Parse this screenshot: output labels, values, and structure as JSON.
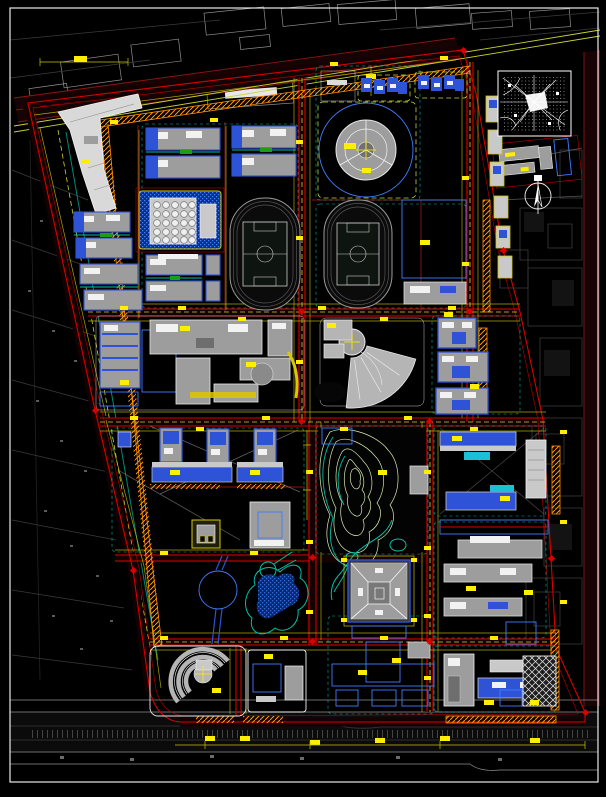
{
  "document": {
    "type": "cad-site-plan",
    "subject": "campus-master-plan"
  },
  "palette": {
    "bg": "#000000",
    "frame_white": "#e9e9e9",
    "road_red": "#d80000",
    "road_dark_red": "#8a1616",
    "road_fill": "#170303",
    "hatch_orange": "#ff9000",
    "annotation_yellow": "#ffee00",
    "dim_yellow": "#c8c400",
    "dash_green": "#c9d32f",
    "hatch_blue": "#3f7dff",
    "hatch_blue_dark": "#0d2f7e",
    "accent_blue": "#2e53d6",
    "building_gray": "#9d9d9d",
    "building_light": "#c9c9c9",
    "outline_white": "#f2f2f2",
    "context_gray": "#3a3a3a",
    "context_light": "#8f8f8f",
    "contour_green": "#d6ecae",
    "cyan": "#00e0d0",
    "teal": "#00c0a8"
  },
  "features": [
    {
      "name": "sheet-frame",
      "kind": "frame",
      "color_key": "frame_white"
    },
    {
      "name": "site-boundary",
      "kind": "boundary",
      "color_key": "road_red"
    },
    {
      "name": "road-network",
      "kind": "road",
      "color_key": "road_red"
    },
    {
      "name": "hatched-road-verges",
      "kind": "road-detail",
      "color_key": "hatch_orange"
    },
    {
      "name": "dormitory-rows",
      "kind": "building-group",
      "color_key": "building_gray"
    },
    {
      "name": "lattice-roof-building",
      "kind": "building",
      "color_key": "building_light"
    },
    {
      "name": "circular-plaza-building",
      "kind": "building",
      "color_key": "hatch_blue"
    },
    {
      "name": "north-dorm-clusters",
      "kind": "building-group",
      "color_key": "accent_blue"
    },
    {
      "name": "northeast-annex-parcel",
      "kind": "building-group",
      "color_key": "building_gray"
    },
    {
      "name": "running-track-west",
      "kind": "sports-field",
      "color_key": "building_light"
    },
    {
      "name": "running-track-east",
      "kind": "sports-field",
      "color_key": "building_light"
    },
    {
      "name": "basketball-court-grid",
      "kind": "sports-field",
      "color_key": "context_light"
    },
    {
      "name": "academic-courtyard-complex",
      "kind": "building-group",
      "color_key": "building_gray"
    },
    {
      "name": "fan-shaped-building",
      "kind": "building",
      "color_key": "building_gray"
    },
    {
      "name": "mid-east-buildings",
      "kind": "building-group",
      "color_key": "accent_blue"
    },
    {
      "name": "southwest-tower-group",
      "kind": "building-group",
      "color_key": "accent_blue"
    },
    {
      "name": "gatehouse",
      "kind": "building",
      "color_key": "dim_yellow"
    },
    {
      "name": "hill-contours",
      "kind": "landscape",
      "color_key": "contour_green"
    },
    {
      "name": "stream",
      "kind": "landscape",
      "color_key": "teal"
    },
    {
      "name": "circular-pond",
      "kind": "landscape",
      "color_key": "hatch_blue"
    },
    {
      "name": "lake",
      "kind": "landscape",
      "color_key": "teal"
    },
    {
      "name": "amphitheater-building",
      "kind": "building",
      "color_key": "building_light"
    },
    {
      "name": "natatorium-block",
      "kind": "building",
      "color_key": "hatch_blue"
    },
    {
      "name": "pyramid-roof-hall",
      "kind": "building",
      "color_key": "building_gray"
    },
    {
      "name": "cross-courtyard-complex",
      "kind": "building-group",
      "color_key": "hatch_blue"
    },
    {
      "name": "east-campus-buildings",
      "kind": "building-group",
      "color_key": "accent_blue"
    },
    {
      "name": "parking-structure",
      "kind": "building",
      "color_key": "outline_white"
    },
    {
      "name": "location-map-inset",
      "kind": "inset-map",
      "color_key": "outline_white"
    },
    {
      "name": "north-arrow",
      "kind": "symbol",
      "color_key": "outline_white"
    },
    {
      "name": "context-city-blocks",
      "kind": "context",
      "color_key": "context_gray"
    },
    {
      "name": "dimension-annotations",
      "kind": "annotation",
      "color_key": "annotation_yellow"
    }
  ]
}
